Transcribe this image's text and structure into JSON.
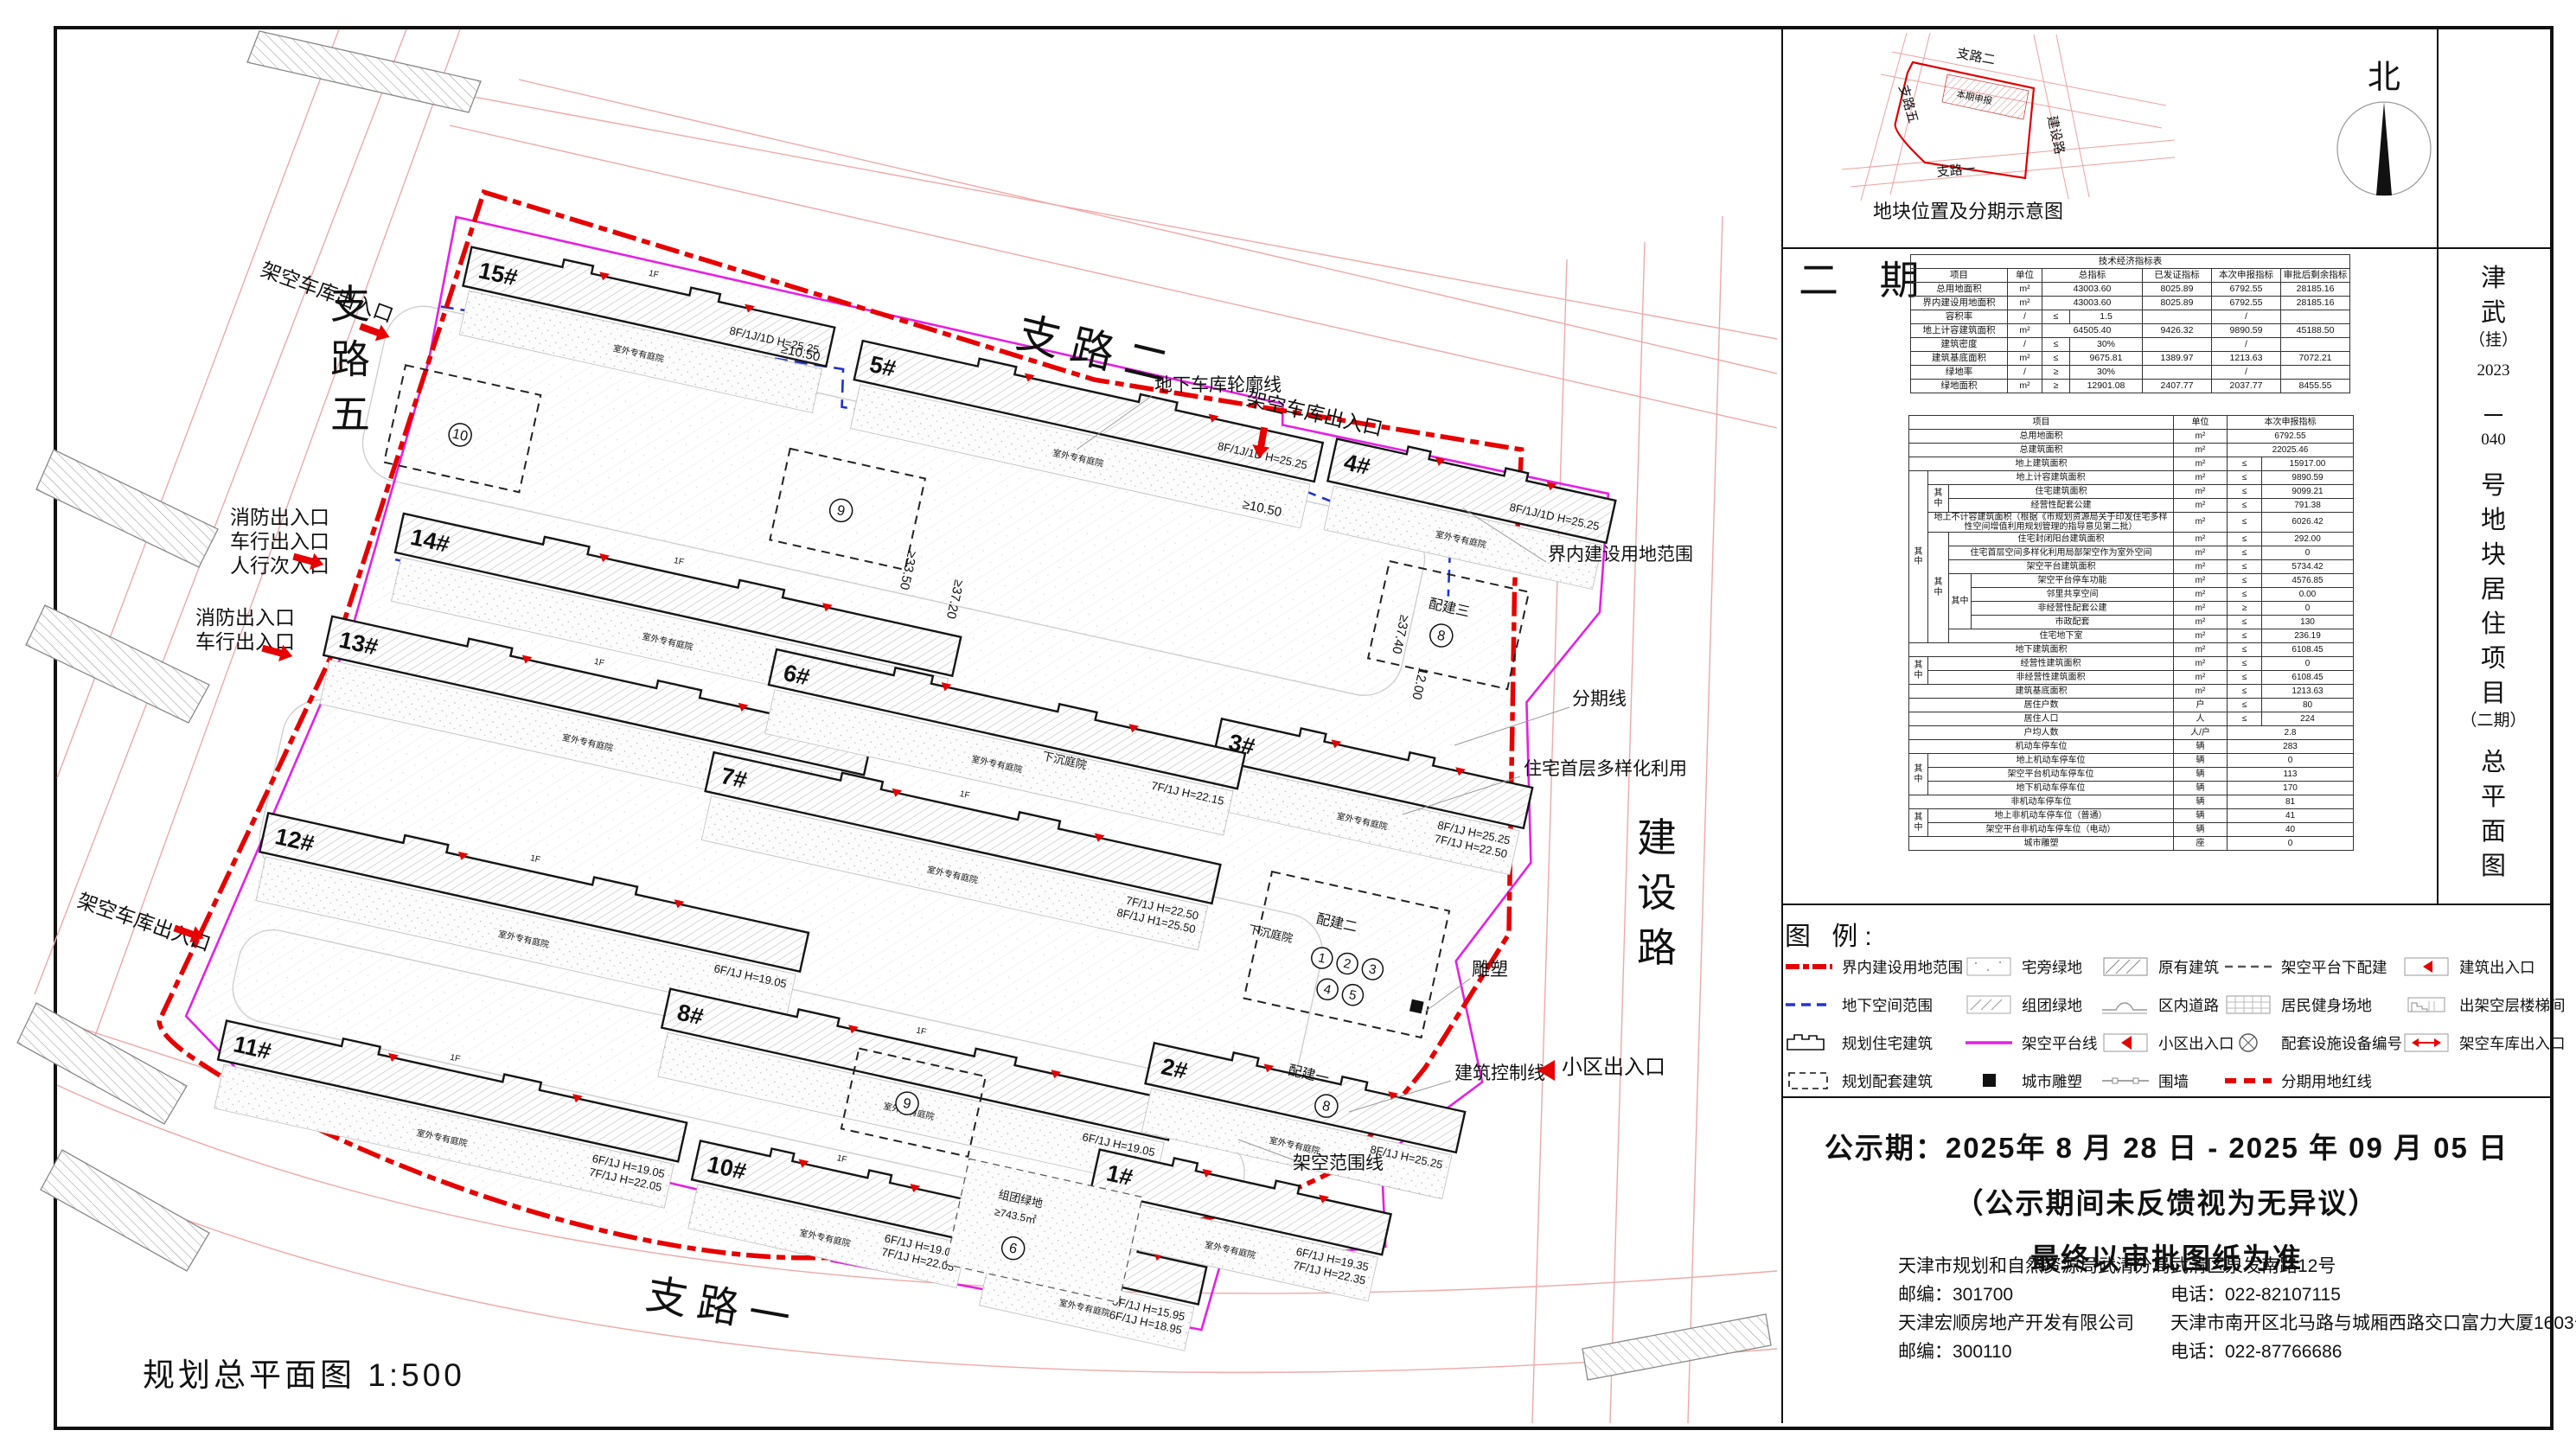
{
  "north_label": "北",
  "phase_big": "二 期",
  "scale_label": "规划总平面图  1:500",
  "title_tokens": [
    "津",
    "武",
    "（挂）",
    "2023",
    "－",
    "040",
    "号",
    "地",
    "块",
    "居",
    "住",
    "项",
    "目",
    "（二期）",
    "总",
    "平",
    "面",
    "图"
  ],
  "inset": {
    "caption": "地块位置及分期示意图",
    "phase_label": "本期申报",
    "roads": {
      "w5": "支路五",
      "n": "支路二",
      "e": "建设路",
      "s": "支路一"
    }
  },
  "plan": {
    "roads": {
      "w5": "支路五",
      "n": "支路二",
      "e": "建设路",
      "s": "支路一"
    },
    "courtyard": "室外专有庭院",
    "f1": "1F",
    "sunken": "下沉庭院",
    "green_group": "组团绿地",
    "green_area": "≥743.5㎡",
    "peibuild1": "配建一",
    "peibuild2": "配建二",
    "peibuild3": "配建三",
    "circles": [
      "10",
      "9",
      "9",
      "6",
      "8",
      "8"
    ],
    "circle_row1": [
      "1",
      "2",
      "3"
    ],
    "circle_row2": [
      "4",
      "5"
    ],
    "buildings": [
      {
        "label": "15#",
        "spec": "8F/1J/1D H=25.25",
        "spec2": ""
      },
      {
        "label": "5#",
        "spec": "8F/1J/1D H=25.25",
        "spec2": ""
      },
      {
        "label": "4#",
        "spec": "8F/1J/1D H=25.25",
        "spec2": ""
      },
      {
        "label": "14#",
        "spec": "7F/1J/1D H=22.15",
        "spec2": ""
      },
      {
        "label": "3#",
        "spec": "8F/1J H=25.25",
        "spec2": "7F/1J H=22.50"
      },
      {
        "label": "13#",
        "spec": "6F/1J H=19.05",
        "spec2": "7F/1J H=22.15"
      },
      {
        "label": "7#",
        "spec": "7F/1J H=22.50",
        "spec2": "8F/1J H1=25.50"
      },
      {
        "label": "6#",
        "spec": "7F/1J H=22.15",
        "spec2": ""
      },
      {
        "label": "12#",
        "spec": "6F/1J H=19.05",
        "spec2": ""
      },
      {
        "label": "8#",
        "spec": "6F/1J H=19.05",
        "spec2": ""
      },
      {
        "label": "2#",
        "spec": "8F/1J H=25.25",
        "spec2": ""
      },
      {
        "label": "11#",
        "spec": "6F/1J H=19.05",
        "spec2": "7F/1J H=22.05"
      },
      {
        "label": "10#",
        "spec": "6F/1J H=19.05",
        "spec2": "7F/1J H=22.05"
      },
      {
        "label": "9#",
        "spec": "5F/1J H=15.95",
        "spec2": "6F/1J H=18.95"
      },
      {
        "label": "1#",
        "spec": "6F/1J H=19.35",
        "spec2": "7F/1J H=22.35"
      }
    ],
    "entrances": {
      "garage": "架空车库出入口",
      "fire": "消防出入口",
      "vehicle": "车行出入口",
      "pedestrian": "人行次入口",
      "community": "小区出入口"
    },
    "callouts": {
      "garage_outline": "地下车库轮廓线",
      "boundary": "界内建设用地范围",
      "phase_line": "分期线",
      "diverse": "住宅首层多样化利用",
      "sculpture": "雕塑",
      "control_line": "建筑控制线",
      "platform_range": "架空范围线"
    },
    "dims": {
      "d1": "≥10.50",
      "d2": "≥33.50",
      "d3": "≥37.20",
      "d4": "≥37.40",
      "d5": "12.00"
    }
  },
  "tables": {
    "t1": {
      "rows": [
        [
          {
            "t": "技术经济指标表",
            "cs": 7
          }
        ],
        [
          "项目",
          "单位",
          {
            "t": "总指标",
            "cs": 2
          },
          "已发证指标",
          "本次申报指标",
          "审批后剩余指标"
        ],
        [
          "总用地面积",
          "m²",
          {
            "t": "43003.60",
            "cs": 2
          },
          "8025.89",
          "6792.55",
          "28185.16"
        ],
        [
          "界内建设用地面积",
          "m²",
          {
            "t": "43003.60",
            "cs": 2
          },
          "8025.89",
          "6792.55",
          "28185.16"
        ],
        [
          "容积率",
          "/",
          "≤",
          "1.5",
          "",
          "/",
          ""
        ],
        [
          "地上计容建筑面积",
          "m²",
          {
            "t": "64505.40",
            "cs": 2
          },
          "9426.32",
          "9890.59",
          "45188.50"
        ],
        [
          "建筑密度",
          "/",
          "≤",
          "30%",
          "",
          "/",
          ""
        ],
        [
          "建筑基底面积",
          "m²",
          "≤",
          "9675.81",
          "1389.97",
          "1213.63",
          "7072.21"
        ],
        [
          "绿地率",
          "/",
          "≥",
          "30%",
          "",
          "/",
          ""
        ],
        [
          "绿地面积",
          "m²",
          "≥",
          "12901.08",
          "2407.77",
          "2037.77",
          "8455.55"
        ]
      ]
    },
    "t2": {
      "rows": [
        [
          {
            "t": "项目",
            "cs": 4
          },
          "单位",
          {
            "t": "本次申报指标",
            "cs": 2
          }
        ],
        [
          {
            "t": "总用地面积",
            "cs": 4
          },
          "m²",
          {
            "t": "6792.55",
            "cs": 2
          }
        ],
        [
          {
            "t": "总建筑面积",
            "cs": 4
          },
          "m²",
          {
            "t": "22025.46",
            "cs": 2
          }
        ],
        [
          {
            "t": "地上建筑面积",
            "cs": 4
          },
          "m²",
          "≤",
          "15917.00"
        ],
        [
          {
            "t": "其中",
            "rs": 12
          },
          {
            "t": "地上计容建筑面积",
            "cs": 3
          },
          "m²",
          "≤",
          "9890.59"
        ],
        [
          {
            "t": "其中",
            "rs": 2
          },
          {
            "t": "住宅建筑面积",
            "cs": 2
          },
          "m²",
          "≤",
          "9099.21"
        ],
        [
          {
            "t": "经营性配套公建",
            "cs": 2
          },
          "m²",
          "≤",
          "791.38"
        ],
        [
          {
            "t": "地上不计容建筑面积（根据《市规划资源局关于印发住宅多样性空间增值利用规划管理的指导意见第二批）",
            "cs": 3,
            "cls": "sm"
          },
          "m²",
          "≤",
          "6026.42"
        ],
        [
          {
            "t": "其中",
            "rs": 8
          },
          {
            "t": "住宅封闭阳台建筑面积",
            "cs": 2
          },
          "m²",
          "≤",
          "292.00"
        ],
        [
          {
            "t": "住宅首层空间多样化利用局部架空作为室外空间",
            "cs": 2,
            "cls": "sm"
          },
          "m²",
          "≤",
          "0"
        ],
        [
          {
            "t": "架空平台建筑面积",
            "cs": 2
          },
          "m²",
          "≤",
          "5734.42"
        ],
        [
          {
            "t": "其中",
            "rs": 4
          },
          "架空平台停车功能",
          "m²",
          "≤",
          "4576.85"
        ],
        [
          "邻里共享空间",
          "m²",
          "≤",
          "0.00"
        ],
        [
          "非经营性配套公建",
          "m²",
          "≥",
          "0"
        ],
        [
          "市政配套",
          "m²",
          "≤",
          "130"
        ],
        [
          {
            "t": "住宅地下室",
            "cs": 2
          },
          "m²",
          "≤",
          "236.19"
        ],
        [
          {
            "t": "地下建筑面积",
            "cs": 4
          },
          "m²",
          "≤",
          "6108.45"
        ],
        [
          {
            "t": "其中",
            "rs": 2
          },
          {
            "t": "经营性建筑面积",
            "cs": 3
          },
          "m²",
          "≤",
          "0"
        ],
        [
          {
            "t": "非经营性建筑面积",
            "cs": 3
          },
          "m²",
          "≤",
          "6108.45"
        ],
        [
          {
            "t": "建筑基底面积",
            "cs": 4
          },
          "m²",
          "≤",
          "1213.63"
        ],
        [
          {
            "t": "居住户数",
            "cs": 4
          },
          "户",
          "≤",
          "80"
        ],
        [
          {
            "t": "居住人口",
            "cs": 4
          },
          "人",
          "≤",
          "224"
        ],
        [
          {
            "t": "户均人数",
            "cs": 4
          },
          "人/户",
          {
            "t": "2.8",
            "cs": 2
          }
        ],
        [
          {
            "t": "机动车停车位",
            "cs": 4
          },
          "辆",
          {
            "t": "283",
            "cs": 2
          }
        ],
        [
          {
            "t": "其中",
            "rs": 3
          },
          {
            "t": "地上机动车停车位",
            "cs": 3
          },
          "辆",
          {
            "t": "0",
            "cs": 2
          }
        ],
        [
          {
            "t": "架空平台机动车停车位",
            "cs": 3
          },
          "辆",
          {
            "t": "113",
            "cs": 2
          }
        ],
        [
          {
            "t": "地下机动车停车位",
            "cs": 3
          },
          "辆",
          {
            "t": "170",
            "cs": 2
          }
        ],
        [
          {
            "t": "非机动车停车位",
            "cs": 4
          },
          "辆",
          {
            "t": "81",
            "cs": 2
          }
        ],
        [
          {
            "t": "其中",
            "rs": 2
          },
          {
            "t": "地上非机动车停车位（普通）",
            "cs": 3
          },
          "辆",
          {
            "t": "41",
            "cs": 2
          }
        ],
        [
          {
            "t": "架空平台非机动车停车位（电动）",
            "cs": 3
          },
          "辆",
          {
            "t": "40",
            "cs": 2
          }
        ],
        [
          {
            "t": "城市雕塑",
            "cs": 4
          },
          "座",
          {
            "t": "0",
            "cs": 2
          }
        ]
      ]
    }
  },
  "legend": {
    "heading": "图 例:",
    "items": [
      {
        "label": "界内建设用地范围"
      },
      {
        "label": "地下空间范围"
      },
      {
        "label": "规划住宅建筑"
      },
      {
        "label": "规划配套建筑"
      },
      {
        "label": "宅旁绿地"
      },
      {
        "label": "组团绿地"
      },
      {
        "label": "架空平台线"
      },
      {
        "label": "城市雕塑"
      },
      {
        "label": "原有建筑"
      },
      {
        "label": "区内道路"
      },
      {
        "label": "小区出入口"
      },
      {
        "label": "围墙"
      },
      {
        "label": "架空平台下配建"
      },
      {
        "label": "居民健身场地"
      },
      {
        "label": "配套设施设备编号"
      },
      {
        "label": "分期用地红线"
      },
      {
        "label": "建筑出入口"
      },
      {
        "label": "出架空层楼梯间"
      },
      {
        "label": "架空车库出入口"
      }
    ]
  },
  "notice": {
    "line1": "公示期：2025年 8 月 28 日 -  2025 年 09 月 05 日",
    "line2": "（公示期间未反馈视为无异议）",
    "line3": "最终以审批图纸为准"
  },
  "contacts": {
    "left": [
      "天津市规划和自然资源局武清分局",
      "邮编：301700",
      "天津宏顺房地产开发有限公司",
      "邮编：300110"
    ],
    "right": [
      "武清区泉发南路12号",
      "电话：022-82107115",
      "天津市南开区北马路与城厢西路交口富力大厦1603号",
      "电话：022-87766686"
    ]
  }
}
